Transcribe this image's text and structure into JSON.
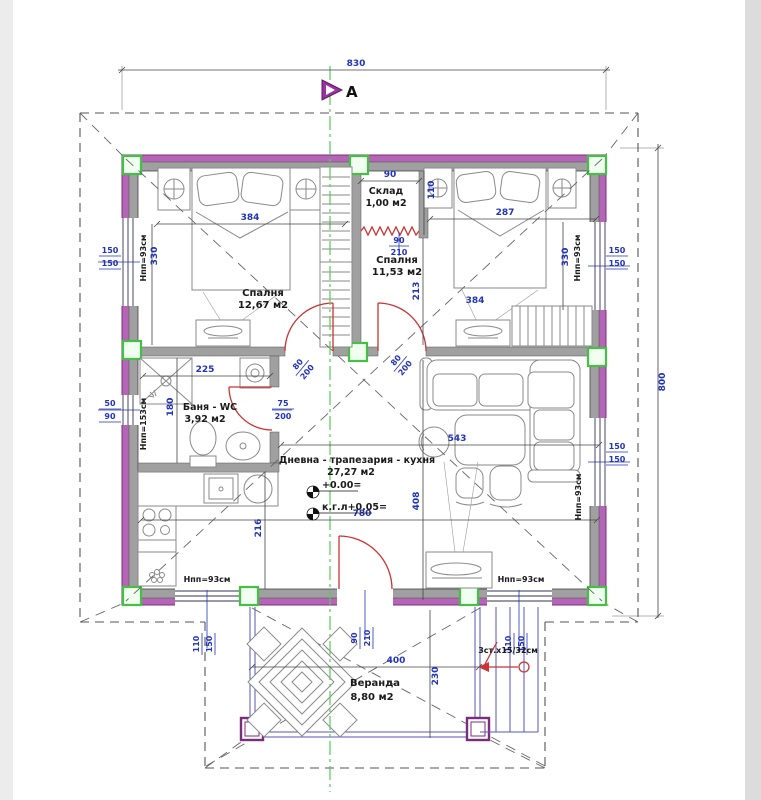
{
  "section": {
    "marker": "A"
  },
  "overall": {
    "width": "830",
    "height": "800"
  },
  "rooms": {
    "bedroom1": {
      "name": "Спалня",
      "area": "12,67 м2",
      "dim_bed": "384",
      "dim_side": "330"
    },
    "storage": {
      "name": "Склад",
      "area": "1,00 м2",
      "dim_w": "90",
      "dim_h": "110"
    },
    "bedroom2": {
      "name": "Спалня",
      "area": "11,53 м2",
      "dim_width": "287",
      "dim_inner": "213",
      "dim_bed": "384",
      "dim_side": "330"
    },
    "bathroom": {
      "name": "Баня - WC",
      "area": "3,92 м2",
      "dim_w": "225",
      "dim_h": "180"
    },
    "living": {
      "name": "Дневна - трапезария - кухня",
      "area": "27,27 м2",
      "dim_w": "543",
      "dim_h": "408",
      "dim_kitchen": "216",
      "dim_total": "780"
    },
    "veranda": {
      "name": "Веранда",
      "area": "8,80 м2",
      "dim_w": "400",
      "dim_h": "230",
      "stairs_note": "3ст.х15/32см"
    }
  },
  "levels": {
    "main": "+0.00=",
    "floor": "к.г.л+0.05="
  },
  "windows": {
    "w150": "150",
    "w110": "110",
    "w90": "90",
    "w50": "50"
  },
  "sills": {
    "s93": "Нпп=93см",
    "s153": "Нпп=153см"
  },
  "openings": {
    "entry": {
      "w": "90",
      "h": "210"
    },
    "room_door": {
      "w": "80",
      "h": "200"
    },
    "bath_door": {
      "w": "75",
      "h": "200"
    },
    "storage_pass": {
      "w": "90",
      "h": "210"
    }
  },
  "colors": {
    "wall_face": "#b565b5",
    "wall_core": "#a0a0a0",
    "column_green": "#44c044",
    "dim_blue": "#2233bb",
    "door_red": "#cc3333",
    "axis_green": "#55cc55"
  }
}
